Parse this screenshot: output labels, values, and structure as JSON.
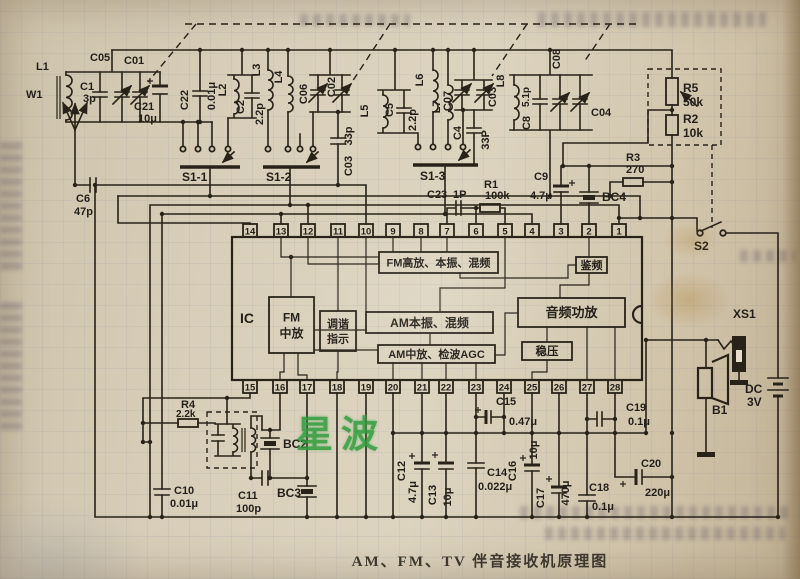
{
  "page": {
    "caption": "AM、FM、TV 伴音接收机原理图",
    "watermark": "星波"
  },
  "colors": {
    "paper": "#d5cab4",
    "ink": "#282218",
    "watermark_green": "#2f9c3c"
  },
  "ic": {
    "label": "IC",
    "top_pins": [
      "14",
      "13",
      "12",
      "11",
      "10",
      "9",
      "8",
      "7",
      "6",
      "5",
      "4",
      "3",
      "2",
      "1"
    ],
    "bottom_pins": [
      "15",
      "16",
      "17",
      "18",
      "19",
      "20",
      "21",
      "22",
      "23",
      "24",
      "25",
      "26",
      "27",
      "28"
    ],
    "blocks": [
      {
        "id": "fm_front",
        "label": "FM高放、本振、混频"
      },
      {
        "id": "am_osc",
        "label": "AM本振、混频"
      },
      {
        "id": "am_if",
        "label": "AM中放、检波AGC"
      },
      {
        "id": "fm_if",
        "label": "FM中放",
        "lines": [
          "FM",
          "中放"
        ]
      },
      {
        "id": "tuning",
        "label": "调谐指示",
        "lines": [
          "调谐",
          "指示"
        ]
      },
      {
        "id": "discr",
        "label": "鉴频"
      },
      {
        "id": "audio",
        "label": "音频功放"
      },
      {
        "id": "reg",
        "label": "稳压"
      }
    ]
  },
  "labels": {
    "W1": "W1",
    "L1": "L1",
    "C1": "C1",
    "C1v": "3p",
    "C05": "C05",
    "C01": "C01",
    "C21": "C21",
    "C21v": "10μ",
    "C22": "C22",
    "C22v": "0.01μ",
    "L2": "L2",
    "C2": "C2",
    "C2v": "2.2p",
    "C6": "C6",
    "C6v": "47p",
    "L3": "L3",
    "L4": "L4",
    "C06": "C06",
    "C02": "C02",
    "C03a_v": "33p",
    "C03a": "C03",
    "L5": "L5",
    "C5": "C5",
    "C5v": "2.2p",
    "L6": "L6",
    "L7": "L7",
    "C07": "C07",
    "C03b": "C03",
    "C4": "C4",
    "C4v": "33P",
    "L8": "L8",
    "C8v": "5.1p",
    "C8": "C8",
    "C08": "C08",
    "C04": "C04",
    "R5": "R5",
    "R5v": "50k",
    "R2": "R2",
    "R2v": "10k",
    "R3": "R3",
    "R3v": "270",
    "C9": "C9",
    "C9v": "4.7μ",
    "BC4": "BC4",
    "C23": "C23",
    "C23v": "1P",
    "R1": "R1",
    "R1v": "100k",
    "S1_1": "S1-1",
    "S1_2": "S1-2",
    "S1_3": "S1-3",
    "S2": "S2",
    "XS1": "XS1",
    "B1": "B1",
    "DC": "DC",
    "DCv": "3V",
    "R4": "R4",
    "R4v": "2.2k",
    "BC2": "BC2",
    "BC3": "BC3",
    "C10": "C10",
    "C10v": "0.01μ",
    "C11": "C11",
    "C11v": "100p",
    "C12": "C12",
    "C12v": "4.7μ",
    "C13": "C13",
    "C13v": "10μ",
    "C14": "C14",
    "C14v": "0.022μ",
    "C15": "C15",
    "C15v": "0.47μ",
    "C16": "C16",
    "C16v": "10μ",
    "C17": "C17",
    "C17v": "470μ",
    "C18": "C18",
    "C18v": "0.1μ",
    "C19": "C19",
    "C19v": "0.1μ",
    "C20": "C20",
    "C20v": "220μ",
    "IC": "IC"
  }
}
